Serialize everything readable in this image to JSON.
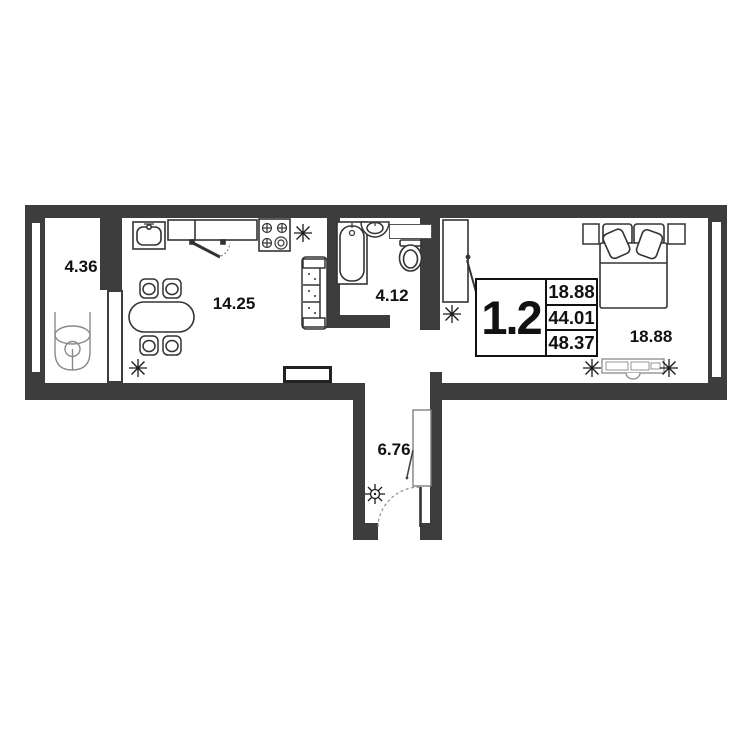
{
  "plan": {
    "title": "apartment-floor-plan",
    "colors": {
      "wall": "#3d3d3d",
      "furniture_line": "#333333",
      "light_line": "#8a8a8a"
    },
    "info_block": {
      "apartment_label": "1.2",
      "values": [
        "18.88",
        "44.01",
        "48.37"
      ]
    },
    "rooms": {
      "loggia": {
        "area": "4.36"
      },
      "kitchen": {
        "area": "14.25"
      },
      "bathroom": {
        "area": "4.12"
      },
      "hall": {
        "area": "6.76"
      },
      "bedroom": {
        "area": "18.88"
      }
    },
    "icons": {
      "ceiling_light": "8-spoke-star",
      "chandelier": "8-spoke-star-with-hub"
    }
  }
}
